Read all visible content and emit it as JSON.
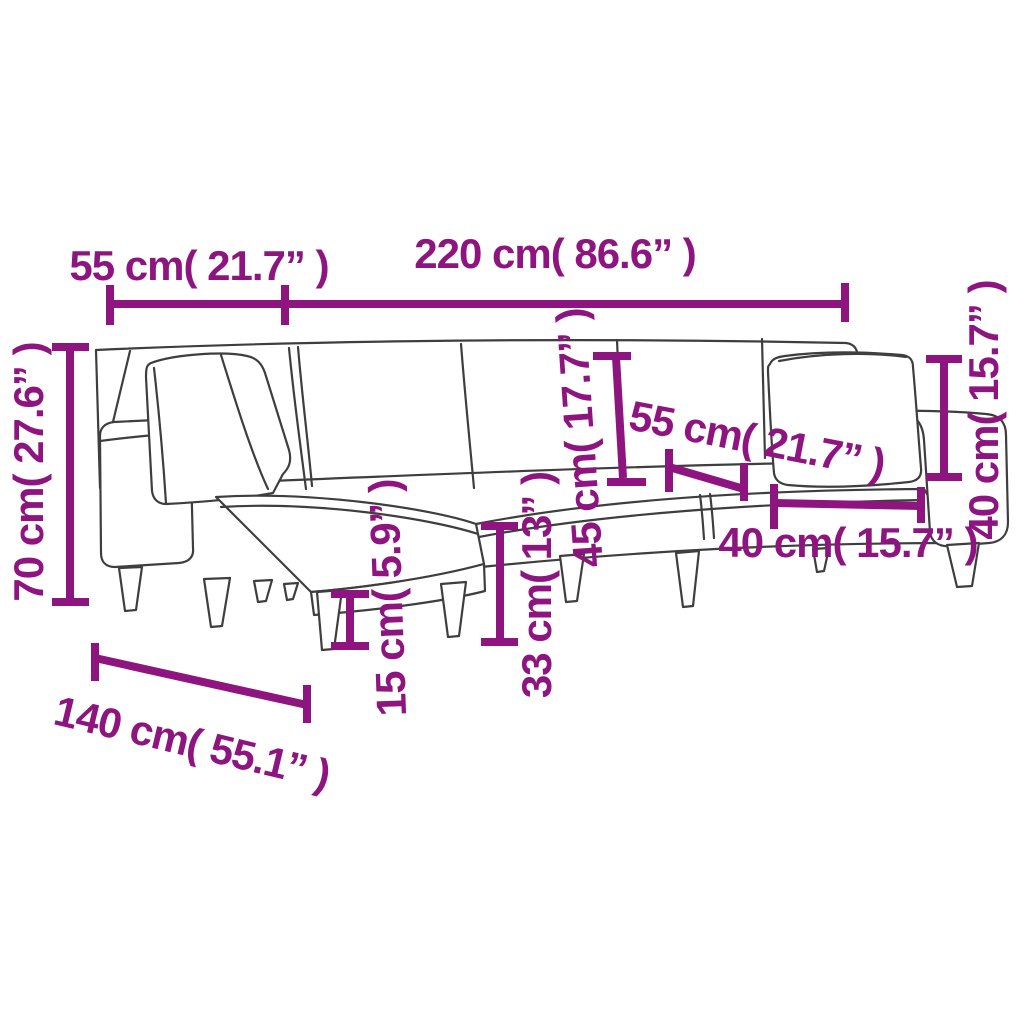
{
  "figure": {
    "type": "furniture-dimension-diagram",
    "subject": "L-shaped sofa bed line drawing with cushions and dimension annotations"
  },
  "colors": {
    "dimension_annotation": "#8E1580",
    "sketch_outline": "#3E3E3E",
    "background": "#FFFFFF"
  },
  "dimensions": [
    {
      "id": "left-section-width-top",
      "text": "55 cm( 21.7” )"
    },
    {
      "id": "total-length-top",
      "text": "220 cm( 86.6” )"
    },
    {
      "id": "overall-height-left",
      "text": "70 cm( 27.6” )"
    },
    {
      "id": "backrest-height-middle",
      "text": "45 cm( 17.7” )"
    },
    {
      "id": "seat-depth-middle",
      "text": "55 cm( 21.7” )"
    },
    {
      "id": "seat-width-right",
      "text": "40 cm( 15.7” )"
    },
    {
      "id": "armrest-height-right",
      "text": "40 cm( 15.7” )"
    },
    {
      "id": "ground-clearance",
      "text": "15 cm( 5.9” )"
    },
    {
      "id": "seat-height",
      "text": "33 cm( 13” )"
    },
    {
      "id": "chaise-depth-bottom",
      "text": "140 cm( 55.1” )"
    }
  ]
}
